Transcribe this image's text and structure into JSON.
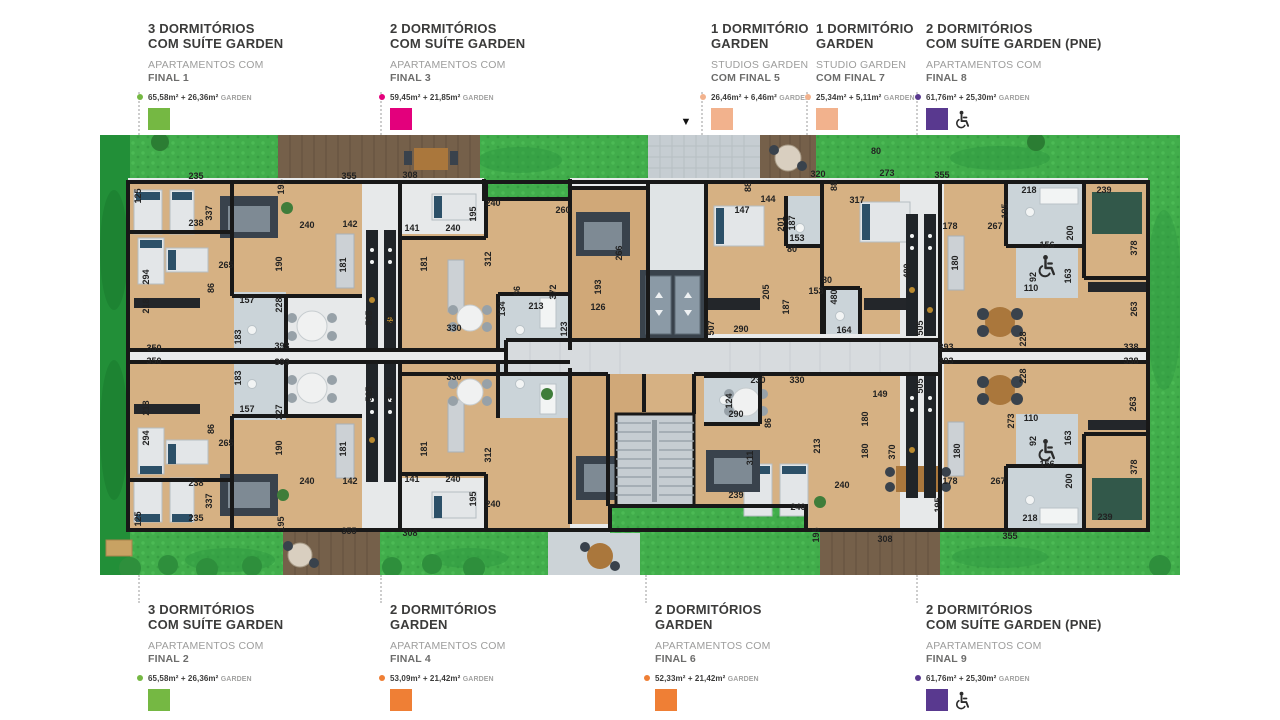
{
  "page": {
    "background": "#ffffff"
  },
  "colors": {
    "green": "#75b843",
    "magenta": "#e3007c",
    "peach": "#f2b28d",
    "purple": "#59398f",
    "orange": "#ef7f35",
    "grass": "#41ad4b",
    "wall": "#181818",
    "wood": "#d6b183"
  },
  "legend_top": [
    {
      "x": 137,
      "title": "3 DORMITÓRIOS\nCOM SUÍTE GARDEN",
      "subtitle_light": "APARTAMENTOS COM",
      "subtitle_dark": "FINAL 1",
      "area": "65,58m² + 26,36m²",
      "area_suffix": "GARDEN",
      "color": "#75b843",
      "pne": false
    },
    {
      "x": 379,
      "title": "2 DORMITÓRIOS\nCOM SUÍTE GARDEN",
      "subtitle_light": "APARTAMENTOS COM",
      "subtitle_dark": "FINAL 3",
      "area": "59,45m² + 21,85m²",
      "area_suffix": "GARDEN",
      "color": "#e3007c",
      "pne": false
    },
    {
      "x": 700,
      "title": "1 DORMITÓRIO\nGARDEN",
      "subtitle_light": "STUDIOS GARDEN",
      "subtitle_dark": "COM FINAL 5",
      "area": "26,46m² + 6,46m²",
      "area_suffix": "GARDEN",
      "color": "#f2b28d",
      "pne": false
    },
    {
      "x": 805,
      "title": "1 DORMITÓRIO\nGARDEN",
      "subtitle_light": "STUDIO GARDEN",
      "subtitle_dark": "COM FINAL 7",
      "area": "25,34m² + 5,11m²",
      "area_suffix": "GARDEN",
      "color": "#f2b28d",
      "pne": false
    },
    {
      "x": 915,
      "title": "2 DORMITÓRIOS\nCOM SUÍTE GARDEN (PNE)",
      "subtitle_light": "APARTAMENTOS COM",
      "subtitle_dark": "FINAL 8",
      "area": "61,76m² + 25,30m²",
      "area_suffix": "GARDEN",
      "color": "#59398f",
      "pne": true
    }
  ],
  "legend_bottom": [
    {
      "x": 137,
      "title": "3 DORMITÓRIOS\nCOM SUÍTE GARDEN",
      "subtitle_light": "APARTAMENTOS COM",
      "subtitle_dark": "FINAL 2",
      "area": "65,58m² + 26,36m²",
      "area_suffix": "GARDEN",
      "color": "#75b843",
      "pne": false
    },
    {
      "x": 379,
      "title": "2 DORMITÓRIOS\nGARDEN",
      "subtitle_light": "APARTAMENTOS COM",
      "subtitle_dark": "FINAL 4",
      "area": "53,09m² + 21,42m²",
      "area_suffix": "GARDEN",
      "color": "#ef7f35",
      "pne": false
    },
    {
      "x": 644,
      "title": "2 DORMITÓRIOS\nGARDEN",
      "subtitle_light": "APARTAMENTOS COM",
      "subtitle_dark": "FINAL 6",
      "area": "52,33m² + 21,42m²",
      "area_suffix": "GARDEN",
      "color": "#ef7f35",
      "pne": false
    },
    {
      "x": 915,
      "title": "2 DORMITÓRIOS\nCOM SUÍTE GARDEN (PNE)",
      "subtitle_light": "APARTAMENTOS COM",
      "subtitle_dark": "FINAL 9",
      "area": "61,76m² + 25,30m²",
      "area_suffix": "GARDEN",
      "color": "#59398f",
      "pne": true
    }
  ],
  "plan": {
    "entrance_marker": "▼",
    "dimension_labels": [
      {
        "t": "125",
        "x": 141,
        "y": 196,
        "v": true
      },
      {
        "t": "235",
        "x": 196,
        "y": 179
      },
      {
        "t": "337",
        "x": 212,
        "y": 213,
        "v": true
      },
      {
        "t": "238",
        "x": 196,
        "y": 226
      },
      {
        "t": "265",
        "x": 226,
        "y": 268
      },
      {
        "t": "86",
        "x": 214,
        "y": 288,
        "v": true
      },
      {
        "t": "294",
        "x": 149,
        "y": 277,
        "v": true
      },
      {
        "t": "218",
        "x": 149,
        "y": 306,
        "v": true
      },
      {
        "t": "157",
        "x": 247,
        "y": 303
      },
      {
        "t": "183",
        "x": 241,
        "y": 337,
        "v": true
      },
      {
        "t": "350",
        "x": 154,
        "y": 351
      },
      {
        "t": "393",
        "x": 282,
        "y": 349
      },
      {
        "t": "190",
        "x": 282,
        "y": 264,
        "v": true
      },
      {
        "t": "240",
        "x": 307,
        "y": 228
      },
      {
        "t": "142",
        "x": 350,
        "y": 227
      },
      {
        "t": "181",
        "x": 346,
        "y": 265,
        "v": true
      },
      {
        "t": "355",
        "x": 349,
        "y": 179
      },
      {
        "t": "195",
        "x": 284,
        "y": 187,
        "v": true
      },
      {
        "t": "228",
        "x": 282,
        "y": 305,
        "v": true
      },
      {
        "t": "505",
        "x": 372,
        "y": 318,
        "v": true
      },
      {
        "t": "392",
        "x": 393,
        "y": 318,
        "v": true
      },
      {
        "t": "308",
        "x": 410,
        "y": 178
      },
      {
        "t": "141",
        "x": 412,
        "y": 231
      },
      {
        "t": "240",
        "x": 453,
        "y": 231
      },
      {
        "t": "195",
        "x": 476,
        "y": 214,
        "v": true
      },
      {
        "t": "240",
        "x": 493,
        "y": 206
      },
      {
        "t": "181",
        "x": 427,
        "y": 264,
        "v": true
      },
      {
        "t": "312",
        "x": 491,
        "y": 259,
        "v": true
      },
      {
        "t": "260",
        "x": 563,
        "y": 213
      },
      {
        "t": "266",
        "x": 622,
        "y": 253,
        "v": true
      },
      {
        "t": "86",
        "x": 520,
        "y": 291,
        "v": true
      },
      {
        "t": "372",
        "x": 556,
        "y": 292,
        "v": true
      },
      {
        "t": "193",
        "x": 601,
        "y": 287,
        "v": true
      },
      {
        "t": "134",
        "x": 505,
        "y": 309,
        "v": true
      },
      {
        "t": "213",
        "x": 536,
        "y": 309
      },
      {
        "t": "123",
        "x": 567,
        "y": 329,
        "v": true
      },
      {
        "t": "126",
        "x": 598,
        "y": 310
      },
      {
        "t": "330",
        "x": 454,
        "y": 331
      },
      {
        "t": "88",
        "x": 751,
        "y": 187,
        "v": true
      },
      {
        "t": "320",
        "x": 818,
        "y": 177
      },
      {
        "t": "88",
        "x": 837,
        "y": 186,
        "v": true
      },
      {
        "t": "273",
        "x": 887,
        "y": 176
      },
      {
        "t": "144",
        "x": 768,
        "y": 202
      },
      {
        "t": "147",
        "x": 742,
        "y": 213
      },
      {
        "t": "317",
        "x": 857,
        "y": 203
      },
      {
        "t": "201",
        "x": 784,
        "y": 224,
        "v": true
      },
      {
        "t": "187",
        "x": 795,
        "y": 223,
        "v": true
      },
      {
        "t": "153",
        "x": 797,
        "y": 241
      },
      {
        "t": "80",
        "x": 792,
        "y": 252
      },
      {
        "t": "80",
        "x": 876,
        "y": 154
      },
      {
        "t": "205",
        "x": 769,
        "y": 292,
        "v": true
      },
      {
        "t": "187",
        "x": 789,
        "y": 307,
        "v": true
      },
      {
        "t": "153",
        "x": 816,
        "y": 294
      },
      {
        "t": "80",
        "x": 827,
        "y": 283
      },
      {
        "t": "480",
        "x": 837,
        "y": 297,
        "v": true
      },
      {
        "t": "507",
        "x": 714,
        "y": 328,
        "v": true
      },
      {
        "t": "290",
        "x": 741,
        "y": 332
      },
      {
        "t": "164",
        "x": 844,
        "y": 333
      },
      {
        "t": "480",
        "x": 910,
        "y": 271,
        "v": true
      },
      {
        "t": "505",
        "x": 923,
        "y": 328,
        "v": true
      },
      {
        "t": "355",
        "x": 942,
        "y": 178
      },
      {
        "t": "218",
        "x": 1029,
        "y": 193
      },
      {
        "t": "239",
        "x": 1104,
        "y": 193
      },
      {
        "t": "195",
        "x": 1008,
        "y": 211,
        "v": true
      },
      {
        "t": "178",
        "x": 950,
        "y": 229
      },
      {
        "t": "267",
        "x": 995,
        "y": 229
      },
      {
        "t": "200",
        "x": 1073,
        "y": 233,
        "v": true
      },
      {
        "t": "156",
        "x": 1047,
        "y": 248
      },
      {
        "t": "92",
        "x": 1036,
        "y": 277,
        "v": true
      },
      {
        "t": "163",
        "x": 1071,
        "y": 276,
        "v": true
      },
      {
        "t": "110",
        "x": 1031,
        "y": 291
      },
      {
        "t": "378",
        "x": 1137,
        "y": 248,
        "v": true
      },
      {
        "t": "263",
        "x": 1137,
        "y": 309,
        "v": true
      },
      {
        "t": "338",
        "x": 1131,
        "y": 350
      },
      {
        "t": "228",
        "x": 1026,
        "y": 339,
        "v": true
      },
      {
        "t": "393",
        "x": 946,
        "y": 350
      },
      {
        "t": "180",
        "x": 958,
        "y": 263,
        "v": true
      },
      {
        "t": "350",
        "x": 154,
        "y": 364
      },
      {
        "t": "393",
        "x": 282,
        "y": 365
      },
      {
        "t": "227",
        "x": 282,
        "y": 412,
        "v": true
      },
      {
        "t": "183",
        "x": 241,
        "y": 378,
        "v": true
      },
      {
        "t": "157",
        "x": 247,
        "y": 412
      },
      {
        "t": "218",
        "x": 149,
        "y": 408,
        "v": true
      },
      {
        "t": "294",
        "x": 149,
        "y": 438,
        "v": true
      },
      {
        "t": "86",
        "x": 214,
        "y": 429,
        "v": true
      },
      {
        "t": "265",
        "x": 226,
        "y": 446
      },
      {
        "t": "190",
        "x": 282,
        "y": 448,
        "v": true
      },
      {
        "t": "181",
        "x": 346,
        "y": 449,
        "v": true
      },
      {
        "t": "240",
        "x": 307,
        "y": 484
      },
      {
        "t": "142",
        "x": 350,
        "y": 484
      },
      {
        "t": "238",
        "x": 196,
        "y": 486
      },
      {
        "t": "337",
        "x": 212,
        "y": 501,
        "v": true
      },
      {
        "t": "125",
        "x": 141,
        "y": 519,
        "v": true
      },
      {
        "t": "235",
        "x": 196,
        "y": 521
      },
      {
        "t": "195",
        "x": 284,
        "y": 524,
        "v": true
      },
      {
        "t": "355",
        "x": 349,
        "y": 534
      },
      {
        "t": "505",
        "x": 372,
        "y": 394,
        "v": true
      },
      {
        "t": "392",
        "x": 393,
        "y": 394,
        "v": true
      },
      {
        "t": "308",
        "x": 410,
        "y": 536
      },
      {
        "t": "141",
        "x": 412,
        "y": 482
      },
      {
        "t": "240",
        "x": 453,
        "y": 482
      },
      {
        "t": "240",
        "x": 493,
        "y": 507
      },
      {
        "t": "195",
        "x": 476,
        "y": 499,
        "v": true
      },
      {
        "t": "181",
        "x": 427,
        "y": 449,
        "v": true
      },
      {
        "t": "312",
        "x": 491,
        "y": 455,
        "v": true
      },
      {
        "t": "330",
        "x": 454,
        "y": 380
      },
      {
        "t": "230",
        "x": 758,
        "y": 383
      },
      {
        "t": "330",
        "x": 797,
        "y": 383
      },
      {
        "t": "124",
        "x": 732,
        "y": 401,
        "v": true
      },
      {
        "t": "290",
        "x": 736,
        "y": 417
      },
      {
        "t": "86",
        "x": 771,
        "y": 423,
        "v": true
      },
      {
        "t": "180",
        "x": 868,
        "y": 419,
        "v": true
      },
      {
        "t": "311",
        "x": 753,
        "y": 458,
        "v": true
      },
      {
        "t": "213",
        "x": 820,
        "y": 446,
        "v": true
      },
      {
        "t": "180",
        "x": 868,
        "y": 451,
        "v": true
      },
      {
        "t": "240",
        "x": 842,
        "y": 488
      },
      {
        "t": "239",
        "x": 736,
        "y": 498
      },
      {
        "t": "240",
        "x": 798,
        "y": 510
      },
      {
        "t": "370",
        "x": 895,
        "y": 452,
        "v": true
      },
      {
        "t": "149",
        "x": 880,
        "y": 397
      },
      {
        "t": "505",
        "x": 923,
        "y": 386,
        "v": true
      },
      {
        "t": "195",
        "x": 819,
        "y": 535,
        "v": true
      },
      {
        "t": "308",
        "x": 885,
        "y": 542
      },
      {
        "t": "393",
        "x": 946,
        "y": 364
      },
      {
        "t": "228",
        "x": 1026,
        "y": 376,
        "v": true
      },
      {
        "t": "338",
        "x": 1131,
        "y": 364
      },
      {
        "t": "273",
        "x": 1014,
        "y": 421,
        "v": true
      },
      {
        "t": "110",
        "x": 1031,
        "y": 421
      },
      {
        "t": "263",
        "x": 1136,
        "y": 404,
        "v": true
      },
      {
        "t": "92",
        "x": 1036,
        "y": 441,
        "v": true
      },
      {
        "t": "163",
        "x": 1071,
        "y": 438,
        "v": true
      },
      {
        "t": "180",
        "x": 960,
        "y": 451,
        "v": true
      },
      {
        "t": "156",
        "x": 1047,
        "y": 467
      },
      {
        "t": "378",
        "x": 1137,
        "y": 467,
        "v": true
      },
      {
        "t": "178",
        "x": 950,
        "y": 484
      },
      {
        "t": "267",
        "x": 998,
        "y": 484
      },
      {
        "t": "200",
        "x": 1072,
        "y": 481,
        "v": true
      },
      {
        "t": "195",
        "x": 941,
        "y": 505,
        "v": true
      },
      {
        "t": "218",
        "x": 1030,
        "y": 521
      },
      {
        "t": "239",
        "x": 1105,
        "y": 520
      },
      {
        "t": "355",
        "x": 1010,
        "y": 539
      }
    ]
  }
}
